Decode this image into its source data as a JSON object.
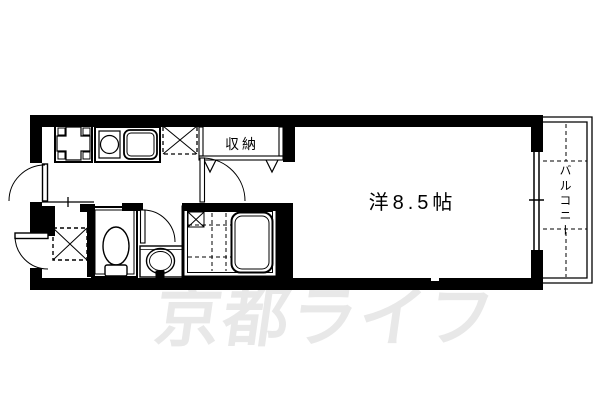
{
  "meta": {
    "type": "apartment-floor-plan",
    "canvas": {
      "width": 600,
      "height": 400
    }
  },
  "colors": {
    "line": "#000000",
    "background": "#ffffff",
    "watermark": "#e8e8e8"
  },
  "labels": {
    "main_room": "洋8.5帖",
    "closet": "収納",
    "balcony": "バルコニー"
  },
  "watermark": {
    "text": "京都ライフ"
  },
  "fixtures": [
    "entrance-door",
    "exterior-storage-door",
    "genkan-step-line",
    "washing-machine-space",
    "toilet",
    "toilet-room",
    "washroom-door",
    "wash-basin",
    "unit-bath",
    "bathtub",
    "bath-door",
    "kitchen-stove",
    "kitchen-counter",
    "kitchen-sink",
    "refrigerator-space",
    "closet-folding-doors",
    "room-door",
    "sliding-window",
    "balcony-railing"
  ]
}
